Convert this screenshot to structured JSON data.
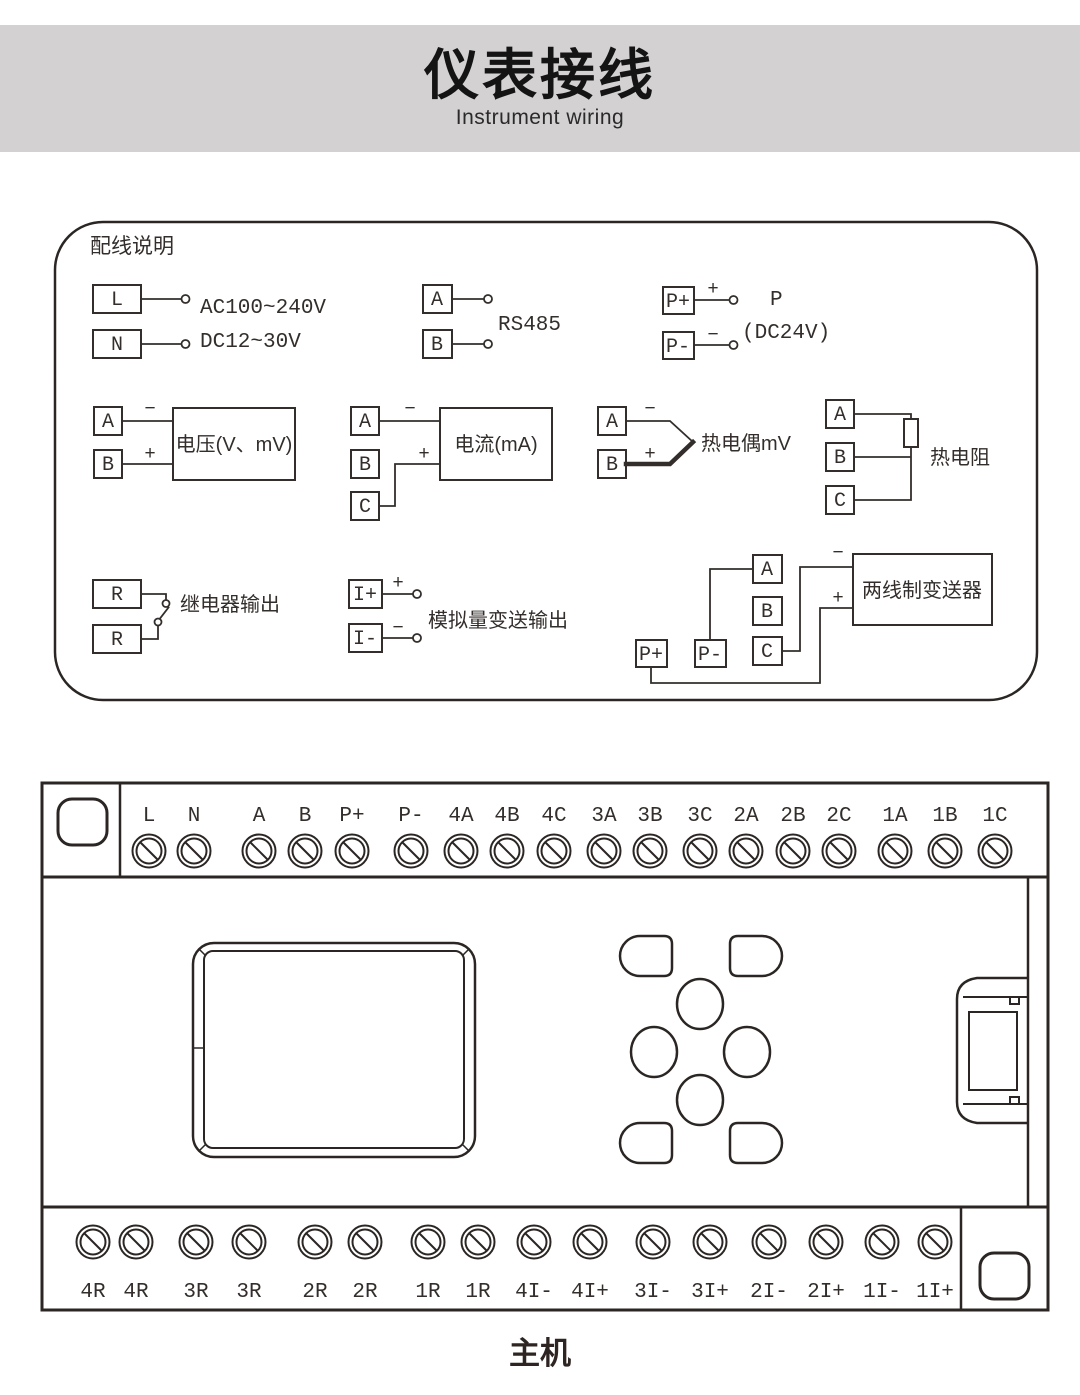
{
  "header": {
    "title": "仪表接线",
    "subtitle": "Instrument wiring"
  },
  "legend": {
    "title": "配线说明",
    "power_supply": {
      "t1": "L",
      "t2": "N",
      "label1": "AC100~240V",
      "label2": "DC12~30V"
    },
    "rs485": {
      "t1": "A",
      "t2": "B",
      "label": "RS485"
    },
    "power_out": {
      "t1": "P+",
      "t2": "P-",
      "plus": "+",
      "minus": "−",
      "label1": "P",
      "label2": "(DC24V)"
    },
    "voltage": {
      "t1": "A",
      "t2": "B",
      "minus": "−",
      "plus": "+",
      "label": "电压(V、mV)"
    },
    "current": {
      "t1": "A",
      "t2": "B",
      "t3": "C",
      "minus": "−",
      "plus": "+",
      "label": "电流(mA)"
    },
    "thermocouple": {
      "t1": "A",
      "t2": "B",
      "minus": "−",
      "plus": "+",
      "label": "热电偶mV"
    },
    "rtd": {
      "t1": "A",
      "t2": "B",
      "t3": "C",
      "label": "热电阻"
    },
    "relay": {
      "t1": "R",
      "t2": "R",
      "label": "继电器输出"
    },
    "analog_out": {
      "t1": "I+",
      "t2": "I-",
      "plus": "+",
      "minus": "−",
      "label": "模拟量变送输出"
    },
    "transmitter": {
      "t1": "A",
      "t2": "B",
      "t3": "C",
      "t4": "P+",
      "t5": "P-",
      "minus": "−",
      "plus": "+",
      "label": "两线制变送器"
    }
  },
  "device": {
    "top_terminals": [
      "L",
      "N",
      "A",
      "B",
      "P+",
      "P-",
      "4A",
      "4B",
      "4C",
      "3A",
      "3B",
      "3C",
      "2A",
      "2B",
      "2C",
      "1A",
      "1B",
      "1C"
    ],
    "bottom_terminals": [
      "4R",
      "4R",
      "3R",
      "3R",
      "2R",
      "2R",
      "1R",
      "1R",
      "4I-",
      "4I+",
      "3I-",
      "3I+",
      "2I-",
      "2I+",
      "1I-",
      "1I+"
    ],
    "caption": "主机"
  },
  "colors": {
    "ink": "#332e2b",
    "header_bg": "#d3d1d1"
  }
}
